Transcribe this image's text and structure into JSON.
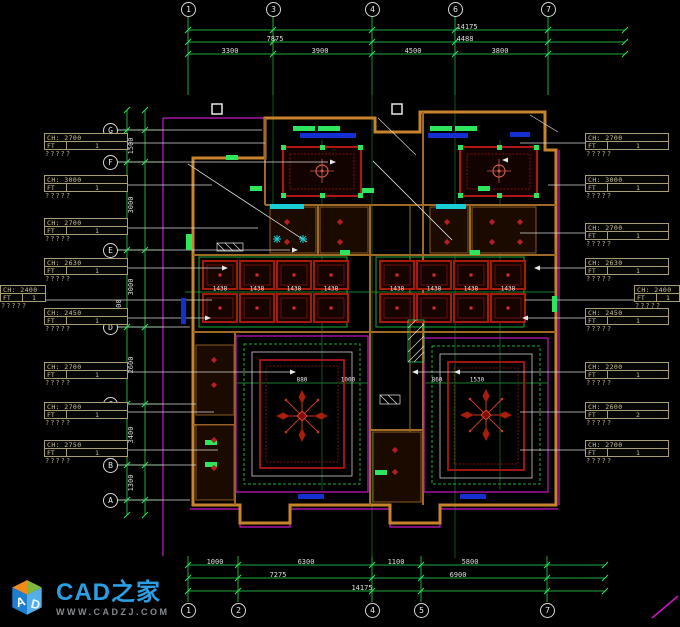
{
  "logo": {
    "title": "CAD之家",
    "subtitle": "WWW.CADZJ.COM",
    "cube": [
      "A",
      "D"
    ]
  },
  "axes": {
    "top_bubbles": [
      {
        "n": "1",
        "x": 188
      },
      {
        "n": "3",
        "x": 273
      },
      {
        "n": "4",
        "x": 372
      },
      {
        "n": "6",
        "x": 455
      },
      {
        "n": "7",
        "x": 548
      }
    ],
    "bottom_bubbles": [
      {
        "n": "1",
        "x": 188
      },
      {
        "n": "2",
        "x": 238
      },
      {
        "n": "4",
        "x": 372
      },
      {
        "n": "5",
        "x": 421
      },
      {
        "n": "7",
        "x": 547
      }
    ],
    "left_bubbles": [
      {
        "n": "G",
        "y": 130
      },
      {
        "n": "F",
        "y": 162
      },
      {
        "n": "E",
        "y": 250
      },
      {
        "n": "D",
        "y": 327
      },
      {
        "n": "C",
        "y": 404
      },
      {
        "n": "B",
        "y": 465
      },
      {
        "n": "A",
        "y": 500
      }
    ]
  },
  "dims": {
    "top": [
      {
        "t": "14175",
        "x": 467,
        "y": 27
      },
      {
        "t": "7875",
        "x": 275,
        "y": 39
      },
      {
        "t": "4488",
        "x": 465,
        "y": 39
      },
      {
        "t": "3300",
        "x": 230,
        "y": 51
      },
      {
        "t": "3900",
        "x": 320,
        "y": 51
      },
      {
        "t": "4500",
        "x": 413,
        "y": 51
      },
      {
        "t": "3800",
        "x": 500,
        "y": 51
      }
    ],
    "bottom": [
      {
        "t": "1000",
        "x": 215,
        "y": 562
      },
      {
        "t": "6300",
        "x": 306,
        "y": 562
      },
      {
        "t": "1100",
        "x": 396,
        "y": 562
      },
      {
        "t": "5800",
        "x": 470,
        "y": 562
      },
      {
        "t": "7275",
        "x": 278,
        "y": 575
      },
      {
        "t": "6900",
        "x": 458,
        "y": 575
      },
      {
        "t": "14175",
        "x": 362,
        "y": 588
      }
    ],
    "left": [
      {
        "t": "1500",
        "x": 131,
        "y": 146
      },
      {
        "t": "3000",
        "x": 131,
        "y": 205
      },
      {
        "t": "3000",
        "x": 131,
        "y": 287
      },
      {
        "t": "14400",
        "x": 119,
        "y": 310
      },
      {
        "t": "2600",
        "x": 131,
        "y": 365
      },
      {
        "t": "3400",
        "x": 131,
        "y": 435
      },
      {
        "t": "1300",
        "x": 131,
        "y": 483
      }
    ],
    "plan": [
      {
        "t": "1438",
        "x": 220,
        "y": 289
      },
      {
        "t": "1438",
        "x": 257,
        "y": 289
      },
      {
        "t": "1438",
        "x": 294,
        "y": 289
      },
      {
        "t": "1438",
        "x": 331,
        "y": 289
      },
      {
        "t": "1438",
        "x": 397,
        "y": 289
      },
      {
        "t": "1438",
        "x": 434,
        "y": 289
      },
      {
        "t": "1438",
        "x": 471,
        "y": 289
      },
      {
        "t": "1438",
        "x": 508,
        "y": 289
      },
      {
        "t": "880",
        "x": 302,
        "y": 380
      },
      {
        "t": "1000",
        "x": 348,
        "y": 380
      },
      {
        "t": "860",
        "x": 437,
        "y": 380
      },
      {
        "t": "1530",
        "x": 477,
        "y": 380
      }
    ]
  },
  "callouts": {
    "left": [
      {
        "ch": "CH: 2700",
        "ft": "FT",
        "v": "1",
        "note": "?????",
        "y": 133
      },
      {
        "ch": "CH: 3000",
        "ft": "FT",
        "v": "1",
        "note": "?????",
        "y": 175
      },
      {
        "ch": "CH: 2700",
        "ft": "FT",
        "v": "1",
        "note": "?????",
        "y": 218
      },
      {
        "ch": "CH: 2630",
        "ft": "FT",
        "v": "1",
        "note": "?????",
        "y": 258
      },
      {
        "ch": "CH: 2450",
        "ft": "FT",
        "v": "1",
        "note": "?????",
        "y": 308
      },
      {
        "ch": "CH: 2700",
        "ft": "FT",
        "v": "1",
        "note": "?????",
        "y": 362
      },
      {
        "ch": "CH: 2700",
        "ft": "FT",
        "v": "1",
        "note": "?????",
        "y": 402
      },
      {
        "ch": "CH: 2750",
        "ft": "FT",
        "v": "1",
        "note": "?????",
        "y": 440
      }
    ],
    "right": [
      {
        "ch": "CH: 2700",
        "ft": "FT",
        "v": "1",
        "note": "?????",
        "y": 133
      },
      {
        "ch": "CH: 3000",
        "ft": "FT",
        "v": "1",
        "note": "?????",
        "y": 175
      },
      {
        "ch": "CH: 2700",
        "ft": "FT",
        "v": "1",
        "note": "?????",
        "y": 223
      },
      {
        "ch": "CH: 2630",
        "ft": "FT",
        "v": "1",
        "note": "?????",
        "y": 258
      },
      {
        "ch": "CH: 2450",
        "ft": "FT",
        "v": "1",
        "note": "?????",
        "y": 308
      },
      {
        "ch": "CH: 2200",
        "ft": "FT",
        "v": "1",
        "note": "?????",
        "y": 362
      },
      {
        "ch": "CH: 2600",
        "ft": "FT",
        "v": "2",
        "note": "?????",
        "y": 402
      },
      {
        "ch": "CH: 2700",
        "ft": "FT",
        "v": "1",
        "note": "?????",
        "y": 440
      }
    ],
    "edge_left": {
      "ch": "CH: 2400",
      "ft": "FT",
      "v": "1",
      "note": "?????",
      "y": 285
    },
    "edge_right": {
      "ch": "CH: 2400",
      "ft": "FT",
      "v": "1",
      "note": "?????",
      "y": 285
    }
  },
  "colors": {
    "line_green": "#1fa83d",
    "bright_green": "#2ee65c",
    "wall_orange": "#c8842d",
    "magenta": "#c818c8",
    "red": "#b01616",
    "dark_red": "#7e0e06",
    "blue": "#1430d2",
    "cyan": "#19cdd4",
    "callout_tan": "#b3aa80",
    "logo_blue": "#2b9fe3"
  }
}
